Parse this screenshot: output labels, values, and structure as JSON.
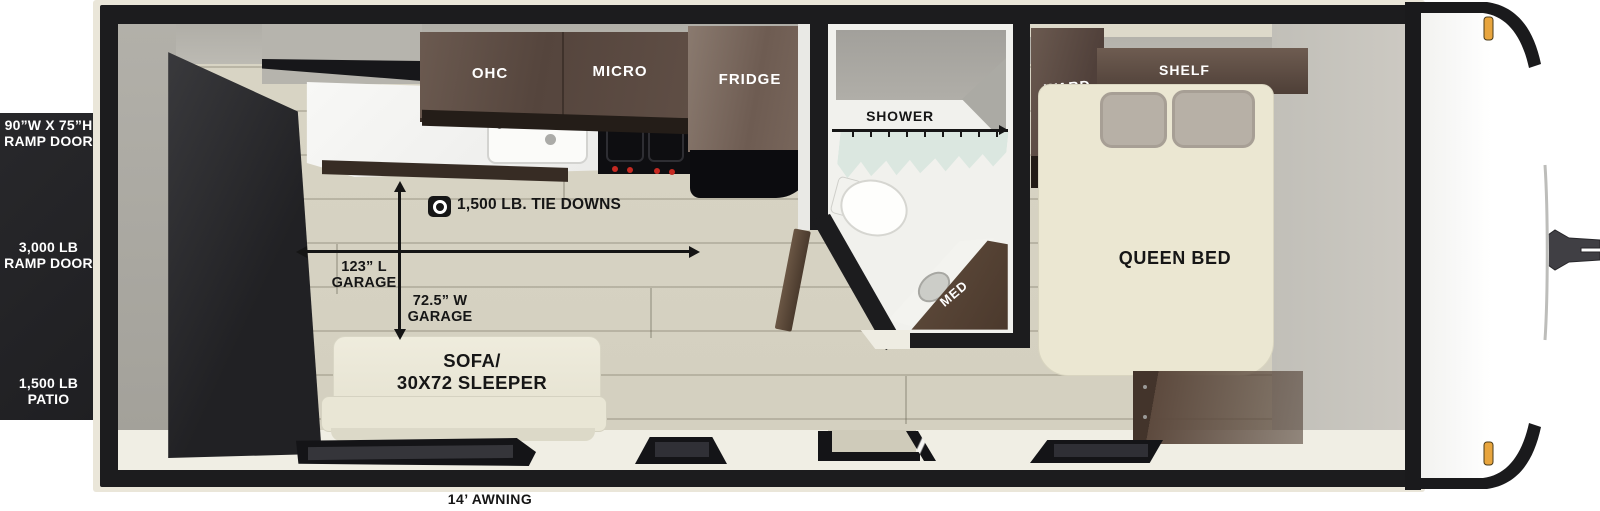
{
  "panel": {
    "ramp_size_line1": "90”W X 75”H",
    "ramp_size_line2": "RAMP DOOR",
    "ramp_weight_line1": "3,000 LB",
    "ramp_weight_line2": "RAMP DOOR",
    "patio_line1": "1,500 LB",
    "patio_line2": "PATIO"
  },
  "kitchen": {
    "ohc": "OHC",
    "micro": "MICRO",
    "fridge": "FRIDGE"
  },
  "bathroom": {
    "shower": "SHOWER",
    "med": "MED"
  },
  "bedroom": {
    "ward": "WARD",
    "shelf": "SHELF",
    "bed": "QUEEN BED"
  },
  "garage": {
    "tie_downs": "1,500 LB. TIE DOWNS",
    "length_line1": "123” L",
    "length_line2": "GARAGE",
    "width_line1": "72.5” W",
    "width_line2": "GARAGE"
  },
  "sofa": {
    "line1": "SOFA/",
    "line2": "30X72 SLEEPER"
  },
  "awning": "14’ AWNING",
  "colors": {
    "wall_black": "#1c1c1e",
    "floor_wood": "#d7d3c3",
    "cabinet_brown": "#5d4a3f",
    "cushion_cream": "#ebe7d2",
    "curtain_mint": "#dbe7e0",
    "marker_amber": "#e8a53e"
  }
}
